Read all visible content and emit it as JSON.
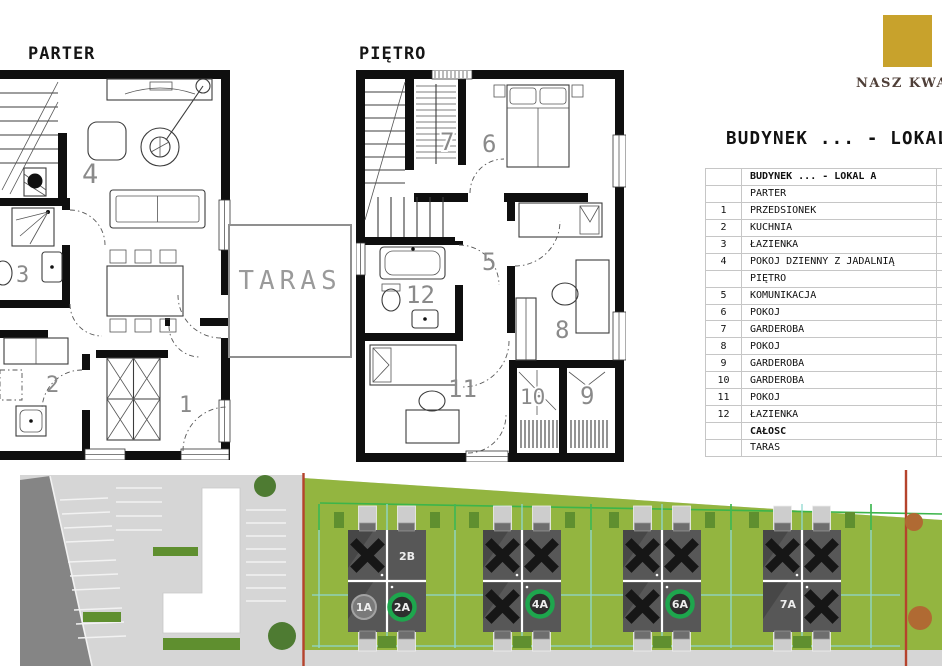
{
  "brand": {
    "name": "NASZ KWADRAT"
  },
  "title": "BUDYNEK ... - LOKAL A",
  "plans": {
    "parter": {
      "label": "PARTER",
      "room_numbers": [
        "4",
        "3",
        "2",
        "1"
      ]
    },
    "pietro": {
      "label": "PIĘTRO",
      "room_numbers": [
        "7",
        "6",
        "5",
        "12",
        "8",
        "11",
        "10",
        "9"
      ]
    },
    "taras": {
      "label": "TARAS"
    }
  },
  "legend_table": {
    "rows": [
      {
        "no": "",
        "name": "BUDYNEK ... - LOKAL A"
      },
      {
        "no": "",
        "name": "PARTER"
      },
      {
        "no": "1",
        "name": "PRZEDSIONEK"
      },
      {
        "no": "2",
        "name": "KUCHNIA"
      },
      {
        "no": "3",
        "name": "ŁAZIENKA"
      },
      {
        "no": "4",
        "name": "POKÓJ DZIENNY Z JADALNIĄ"
      },
      {
        "no": "",
        "name": "PIĘTRO"
      },
      {
        "no": "5",
        "name": "KOMUNIKACJA"
      },
      {
        "no": "6",
        "name": "POKÓJ"
      },
      {
        "no": "7",
        "name": "GARDEROBA"
      },
      {
        "no": "8",
        "name": "POKÓJ"
      },
      {
        "no": "9",
        "name": "GARDEROBA"
      },
      {
        "no": "10",
        "name": "GARDEROBA"
      },
      {
        "no": "11",
        "name": "POKÓJ"
      },
      {
        "no": "12",
        "name": "ŁAZIENKA"
      },
      {
        "no": "",
        "name": "CAŁOŚĆ"
      },
      {
        "no": "",
        "name": "TARAS"
      }
    ]
  },
  "site_plan": {
    "units": [
      {
        "id": "2B",
        "marker": "white-text"
      },
      {
        "id": "1A",
        "marker": "grey-circle"
      },
      {
        "id": "2A",
        "marker": "green-circle"
      },
      {
        "id": "4A",
        "marker": "green-circle"
      },
      {
        "id": "6A",
        "marker": "green-circle"
      },
      {
        "id": "7A",
        "marker": "grey-text"
      }
    ]
  },
  "colors": {
    "gold": "#c8a22c",
    "brandtext": "#4f3f38",
    "wall": "#0f0f0f",
    "roomnum": "#8a8a8a",
    "tborder": "#c6c6c6",
    "grass": "#93b540",
    "road": "#d6d6d6",
    "roaddark": "#858585",
    "building": "#575757",
    "buildingshade": "#474747",
    "xmark": "#161616",
    "greenring": "#1ea64d",
    "greycircle": "#7a7a7a",
    "redline": "#b5432c",
    "teal": "#8fd8d0",
    "plotgreen": "#3cb54a",
    "hedge": "#5f8f2f",
    "tree": "#4e7b32",
    "autumn": "#b06a33"
  }
}
